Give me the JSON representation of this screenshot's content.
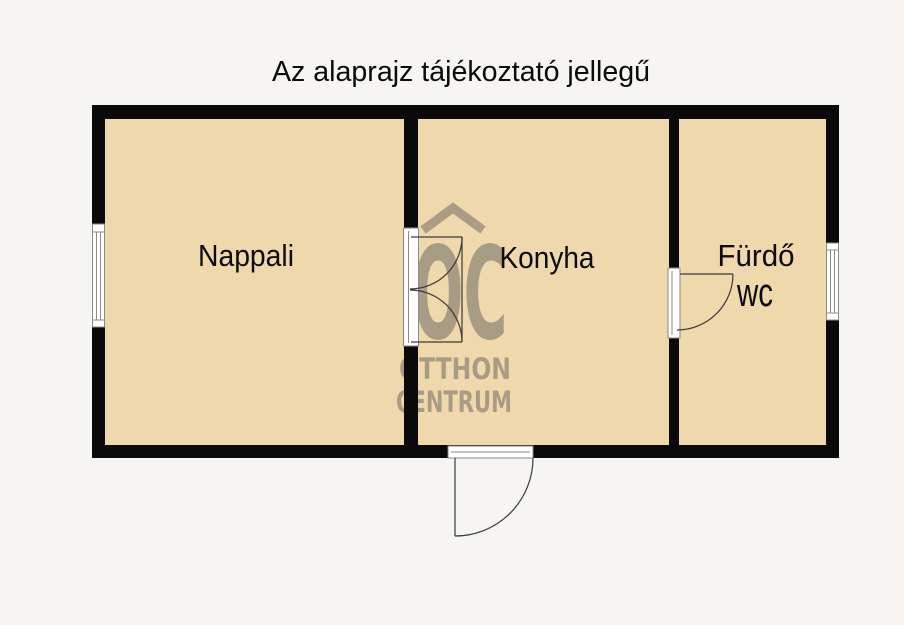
{
  "title": "Az alaprajz tájékoztató jellegű",
  "floorplan": {
    "rooms": [
      {
        "label": "Nappali"
      },
      {
        "label": "Konyha"
      },
      {
        "label": "Fürdő",
        "sublabel": "wc"
      }
    ],
    "watermark": {
      "logo_text": "OC",
      "line1": "OTTHON",
      "line2": "CENTRUM"
    }
  },
  "colors": {
    "background": "#f6f5f1",
    "room_fill": "#f0d8ad",
    "wall": "#0a0a0a",
    "watermark": "#555555"
  }
}
